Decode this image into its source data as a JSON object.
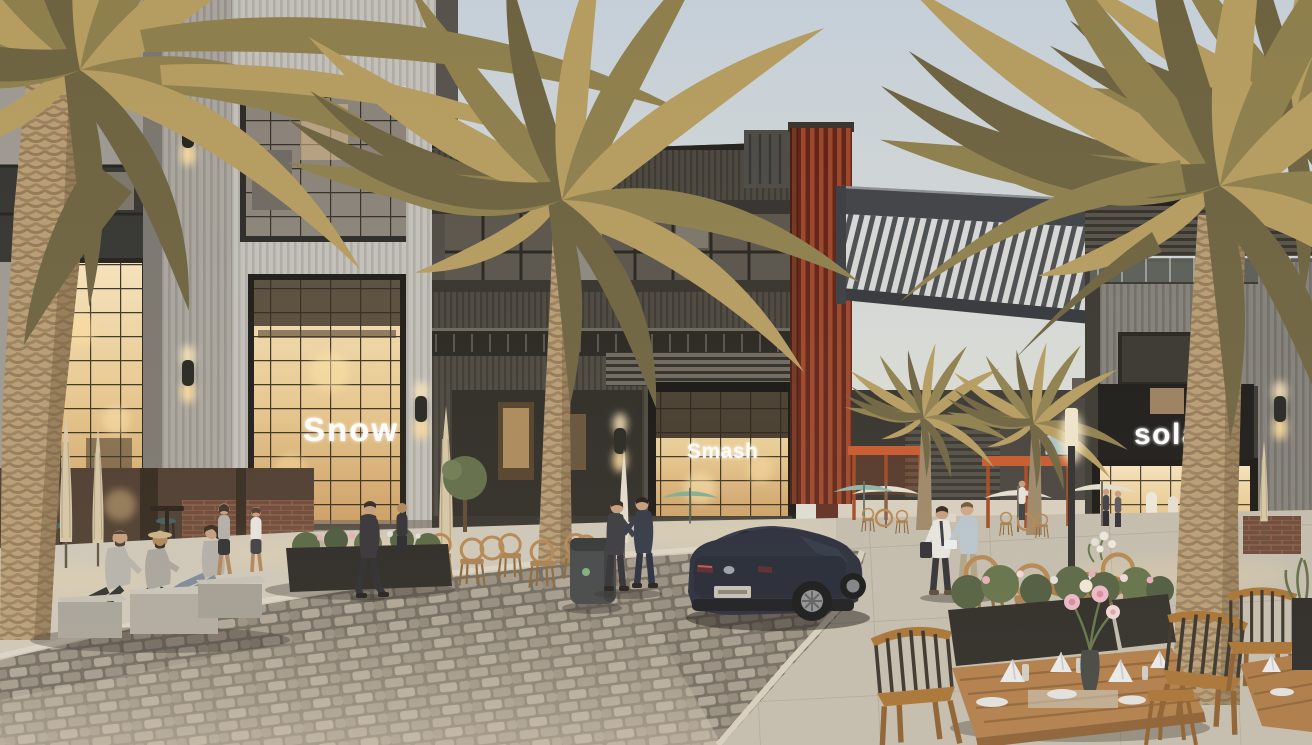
{
  "meta": {
    "title": "Dusk architectural rendering of an open-air retail plaza with palm trees",
    "render_type": "photoreal 3D visualization",
    "time_of_day": "dusk"
  },
  "signs": {
    "left_store": "Snow",
    "center_store": "Smash",
    "right_store": "sola"
  },
  "scene": {
    "setting": "mixed-use retail promenade with cobblestone street",
    "elements": [
      "tall date palm trees",
      "light gray corrugated-metal retail building (left)",
      "dark bronze retail building with balconies (center)",
      "corten-steel rust accent tower",
      "slatted pergola sky bridge between buildings",
      "storefronts glowing with warm interior light",
      "dark blue sedan parked on cobblestone street",
      "wooden outdoor dining tables with folded white napkins and flowers",
      "rattan cafe chairs and closed patio umbrellas",
      "concrete cube benches with three seated people",
      "pedestrians in business attire",
      "orange plaza shade canopies in background",
      "white patio umbrellas",
      "street lamp and cylindrical wall sconces",
      "dark planter boxes with shrubs and pink flowers",
      "gray trash bin"
    ]
  },
  "palette": {
    "sky_top": "#c5cfd8",
    "sky_horizon": "#ece5d6",
    "cladding_light": "#c3c0ba",
    "cladding_dark": "#4e4a43",
    "corten_rust": "#9c4429",
    "warm_glass": "#f0d9ac",
    "pergola_slat": "#d6d8d7",
    "cobblestone": "#958d80",
    "plaza_concrete": "#c4bdae",
    "car_body": "#232837",
    "palm_frond": "#a5905a",
    "palm_trunk": "#b49a72",
    "canopy_orange": "#c8572a",
    "wood_furniture": "#b07a44",
    "napkin": "#ecedee",
    "sign_text": "#ffffff"
  }
}
